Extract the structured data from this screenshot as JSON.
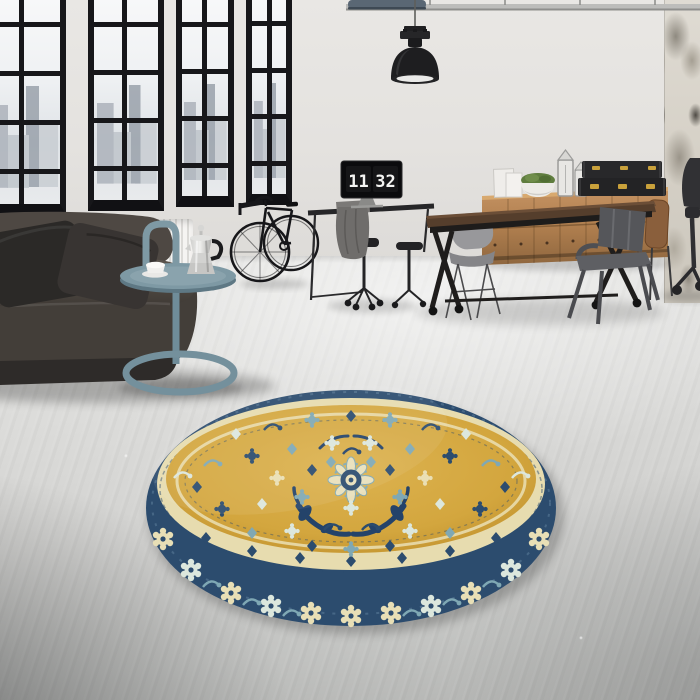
{
  "image": {
    "kind": "interior product photograph",
    "description": "Industrial loft interior with black-framed factory windows, dark leather sofa, blue-grey tray side table with moka pot, bicycle, pendant lamp, workspace with monitor flip-clock, wood trestle table with metal chairs, wooden drawer sideboard with black brass-fitted trunks, distressed plaster column, and a round gold-and-navy traditional oriental rug centered on a concrete floor"
  },
  "clock": {
    "hours": "11",
    "minutes": "32"
  },
  "palette": {
    "wall": "#E6E4E1",
    "distressed_column": "#D2CDC3",
    "floor_light": "#E7E7E5",
    "floor_dark": "#ABACAA",
    "window_frame": "#17171A",
    "sofa_leather": "#48423C",
    "pillow": "#2C2A28",
    "side_table_teal": "#7E99A4",
    "radiator": "#F0EFED",
    "wood_sideboard": "#B08354",
    "table_top_walnut": "#553E2C",
    "trunk_black": "#242426",
    "trunk_brass": "#C9A13B",
    "rug_field_gold": "#D3A63E",
    "rug_border_navy": "#2C4C6E",
    "rug_cream": "#E7DCAF",
    "rug_teal": "#7FA8B4"
  },
  "objects": [
    {
      "name": "window-wall",
      "label": "Black framed factory windows with city view"
    },
    {
      "name": "radiator",
      "label": "White panel radiator"
    },
    {
      "name": "sofa",
      "label": "Dark leather sofa with two cushions"
    },
    {
      "name": "side-table",
      "label": "Blue-grey loop-base tray table"
    },
    {
      "name": "moka-pot",
      "label": "Stainless moka pot"
    },
    {
      "name": "coffee-cup",
      "label": "White cup and saucer"
    },
    {
      "name": "bicycle",
      "label": "Black bicycle leaning on wall"
    },
    {
      "name": "pendant-lamp",
      "label": "Black industrial pendant lamp"
    },
    {
      "name": "ceiling-pipe",
      "label": "Ceiling conduit pipe"
    },
    {
      "name": "desk",
      "label": "Black desk with draped jacket"
    },
    {
      "name": "monitor-clock",
      "label": "Monitor showing flip clock 11:32"
    },
    {
      "name": "office-stools",
      "label": "Black swivel stools"
    },
    {
      "name": "work-table",
      "label": "Industrial walnut-top trestle table on casters"
    },
    {
      "name": "eames-chair",
      "label": "Grey shell chair"
    },
    {
      "name": "metal-armchair",
      "label": "Grey metal armchair"
    },
    {
      "name": "sideboard",
      "label": "Oak drawer sideboard"
    },
    {
      "name": "storage-trunks",
      "label": "Black trunks with brass fittings"
    },
    {
      "name": "planter",
      "label": "White bowl planter with moss"
    },
    {
      "name": "lanterns",
      "label": "Silver candle lanterns and clock"
    },
    {
      "name": "distressed-column",
      "label": "Distressed plaster column"
    },
    {
      "name": "desk-chair",
      "label": "Black office chair (edge of frame)"
    },
    {
      "name": "round-rug",
      "label": "Round gold oriental rug with navy floral border"
    }
  ]
}
